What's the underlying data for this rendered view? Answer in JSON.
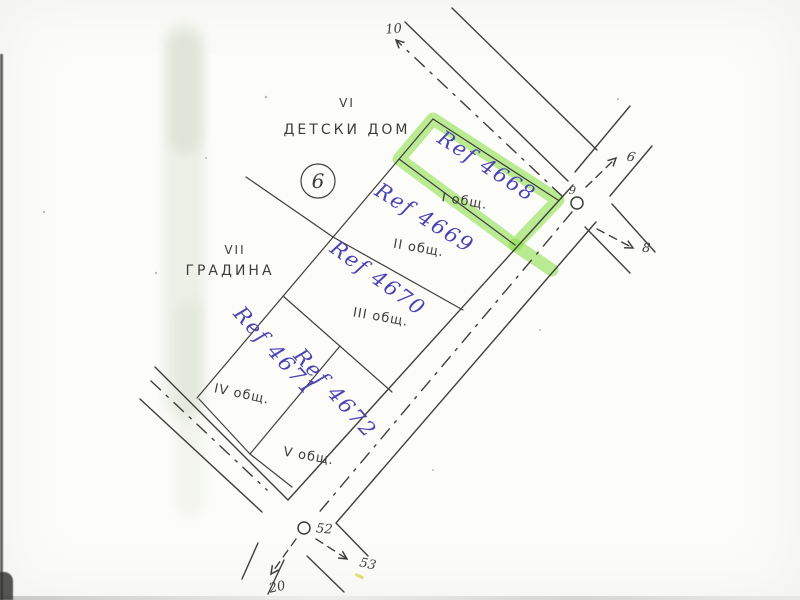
{
  "scan": {
    "regions": [
      {
        "numeral": "VI",
        "name": "ДЕТСКИ ДОМ"
      },
      {
        "numeral": "VII",
        "name": "ГРАДИНА"
      }
    ],
    "block_circle_number": "6",
    "plots": [
      {
        "ref": "Ref 4668",
        "zone": "I общ.",
        "highlighted": true
      },
      {
        "ref": "Ref 4669",
        "zone": "II общ.",
        "highlighted": false
      },
      {
        "ref": "Ref 4670",
        "zone": "III общ.",
        "highlighted": false
      },
      {
        "ref": "Ref 4671",
        "zone": "IV общ.",
        "highlighted": false
      },
      {
        "ref": "Ref 4672",
        "zone": "V общ.",
        "highlighted": false
      }
    ],
    "waypoints": {
      "north_road_end": "10",
      "north_junction": "9",
      "northeast_branch": "6",
      "southeast_branch": "8",
      "south_junction": "52",
      "south_southeast_branch": "53",
      "southwest_branch": "20"
    },
    "colors": {
      "ink": "#3f3e3a",
      "pen_blue": "#4a43b4",
      "highlight_green": "#84dd3f",
      "paper": "#fcfcf9"
    }
  }
}
